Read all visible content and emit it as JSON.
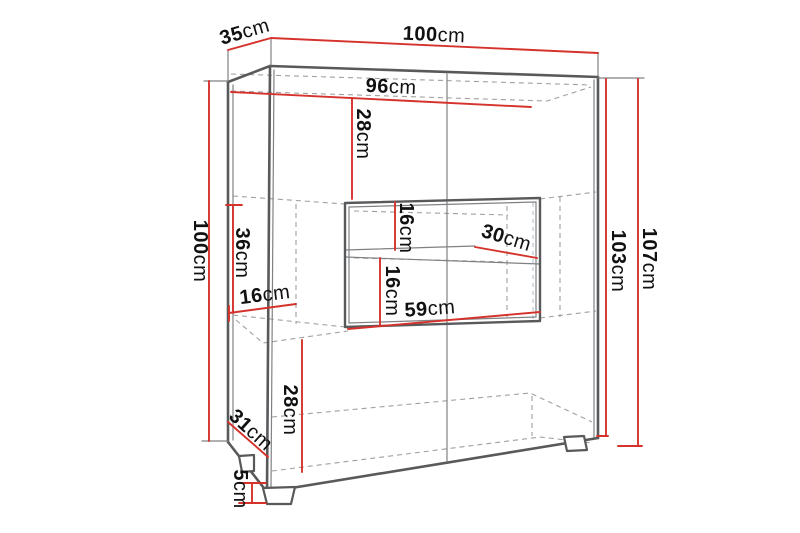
{
  "meta": {
    "description": "Technical dimension diagram of a display cabinet (highboard) drawn in perspective with red dimension lines"
  },
  "colors": {
    "dimension_line": "#d5322b",
    "edge": "#58595b",
    "edge_thin": "#808184",
    "hidden_edge": "#a0a0a2",
    "accent_dashed": "#b9c6d2",
    "label_text": "#111111",
    "background": "#ffffff"
  },
  "dims": {
    "top_depth": {
      "value": "35",
      "unit": "cm"
    },
    "top_width": {
      "value": "100",
      "unit": "cm"
    },
    "interior_width": {
      "value": "96",
      "unit": "cm"
    },
    "top_section_height": {
      "value": "28",
      "unit": "cm"
    },
    "niche_upper_height": {
      "value": "16",
      "unit": "cm"
    },
    "shelf_depth": {
      "value": "30",
      "unit": "cm"
    },
    "niche_lower_height": {
      "value": "16",
      "unit": "cm"
    },
    "niche_width": {
      "value": "59",
      "unit": "cm"
    },
    "left_upper_height": {
      "value": "36",
      "unit": "cm"
    },
    "left_inset": {
      "value": "16",
      "unit": "cm"
    },
    "left_height": {
      "value": "100",
      "unit": "cm"
    },
    "body_height": {
      "value": "103",
      "unit": "cm"
    },
    "total_height": {
      "value": "107",
      "unit": "cm"
    },
    "bottom_depth": {
      "value": "31",
      "unit": "cm"
    },
    "bottom_section_height": {
      "value": "28",
      "unit": "cm"
    },
    "leg_height": {
      "value": "5",
      "unit": "cm"
    }
  }
}
